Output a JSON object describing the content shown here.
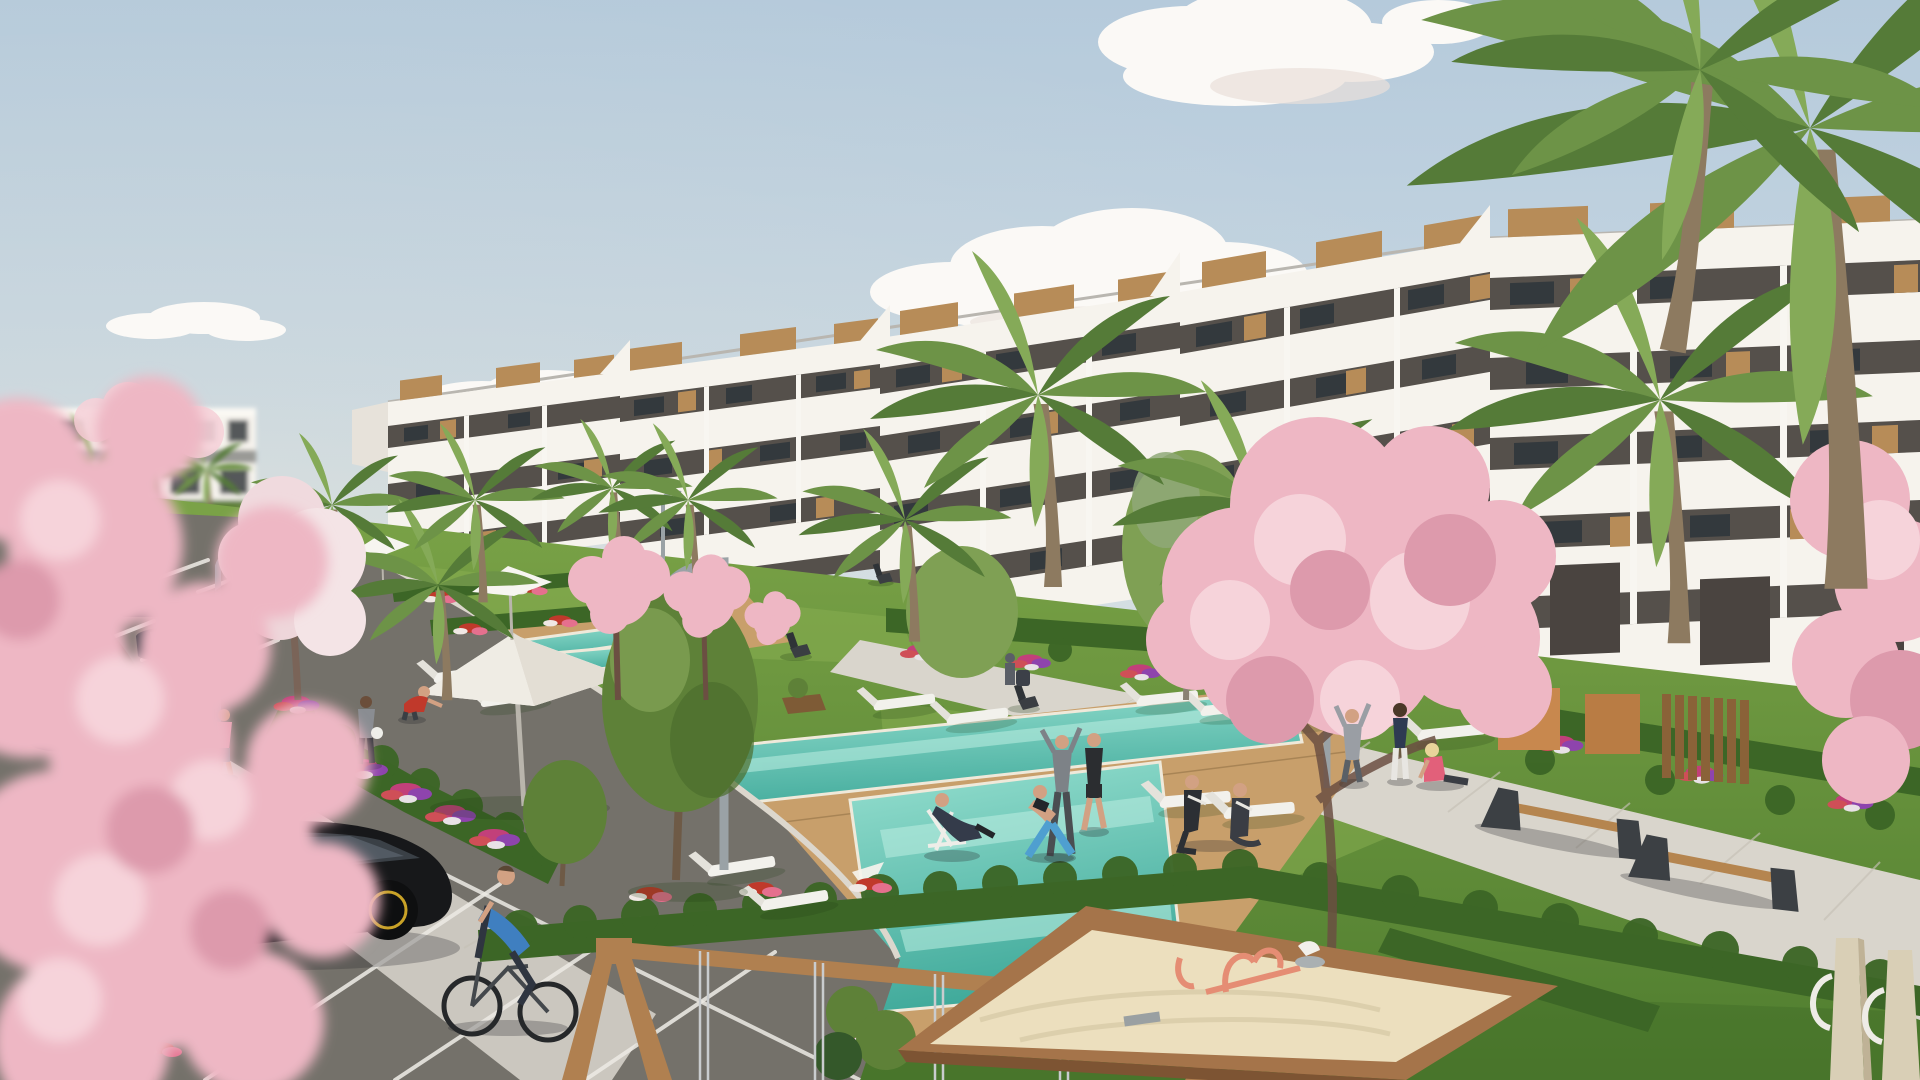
{
  "scene": {
    "title": "Sunny 3D exterior render of a new-build apartment resort community",
    "type": "architectural-visualization",
    "weather": "clear sky with scattered white clouds",
    "objects": [
      "stepped white apartment building with wood cladding and glass balconies",
      "distant low white residential block",
      "turquoise swimming pools with timber sun deck",
      "white parasols and sun loungers",
      "lawns, clipped hedges and flower beds",
      "palm trees and pink cherry-blossom trees",
      "curved grey street lamps",
      "timber benches on paved walkway",
      "asphalt parking lot with marked bays and parked cars",
      "black hatchback car",
      "man riding bicycle",
      "joggers on sidewalk",
      "people exercising and relaxing on lawn",
      "wooden swing frame",
      "sand pit playground with coral play equipment",
      "timber play posts"
    ]
  },
  "palette": {
    "sky_top": "#b5cadb",
    "sky_mid": "#cfdce5",
    "sky_horizon": "#f1e8d8",
    "cloud": "#fbf9f6",
    "building_white": "#f6f3ed",
    "balcony_shadow": "#55504b",
    "window_glass": "#33393d",
    "wood_cladding": "#b78c58",
    "terracotta": "#c8884e",
    "grass_light": "#7ca448",
    "grass_dark": "#4f7d2f",
    "hedge": "#3c6626",
    "pool_light": "#97e0d0",
    "pool_deep": "#3fa99a",
    "deck_wood": "#c89f6b",
    "path_grey": "#d9d5cc",
    "asphalt": "#74716a",
    "blossom_pink": "#eeb7c4",
    "blossom_light": "#f6d3da",
    "blossom_deep": "#dd9aac",
    "sand": "#ecdfbe",
    "sandbox_wood": "#a5744a",
    "play_wood": "#b08050",
    "play_coral": "#e58d74",
    "car_black": "#17181a",
    "lamp_grey": "#9aa2a6",
    "umbrella_white": "#f7f5f0"
  }
}
